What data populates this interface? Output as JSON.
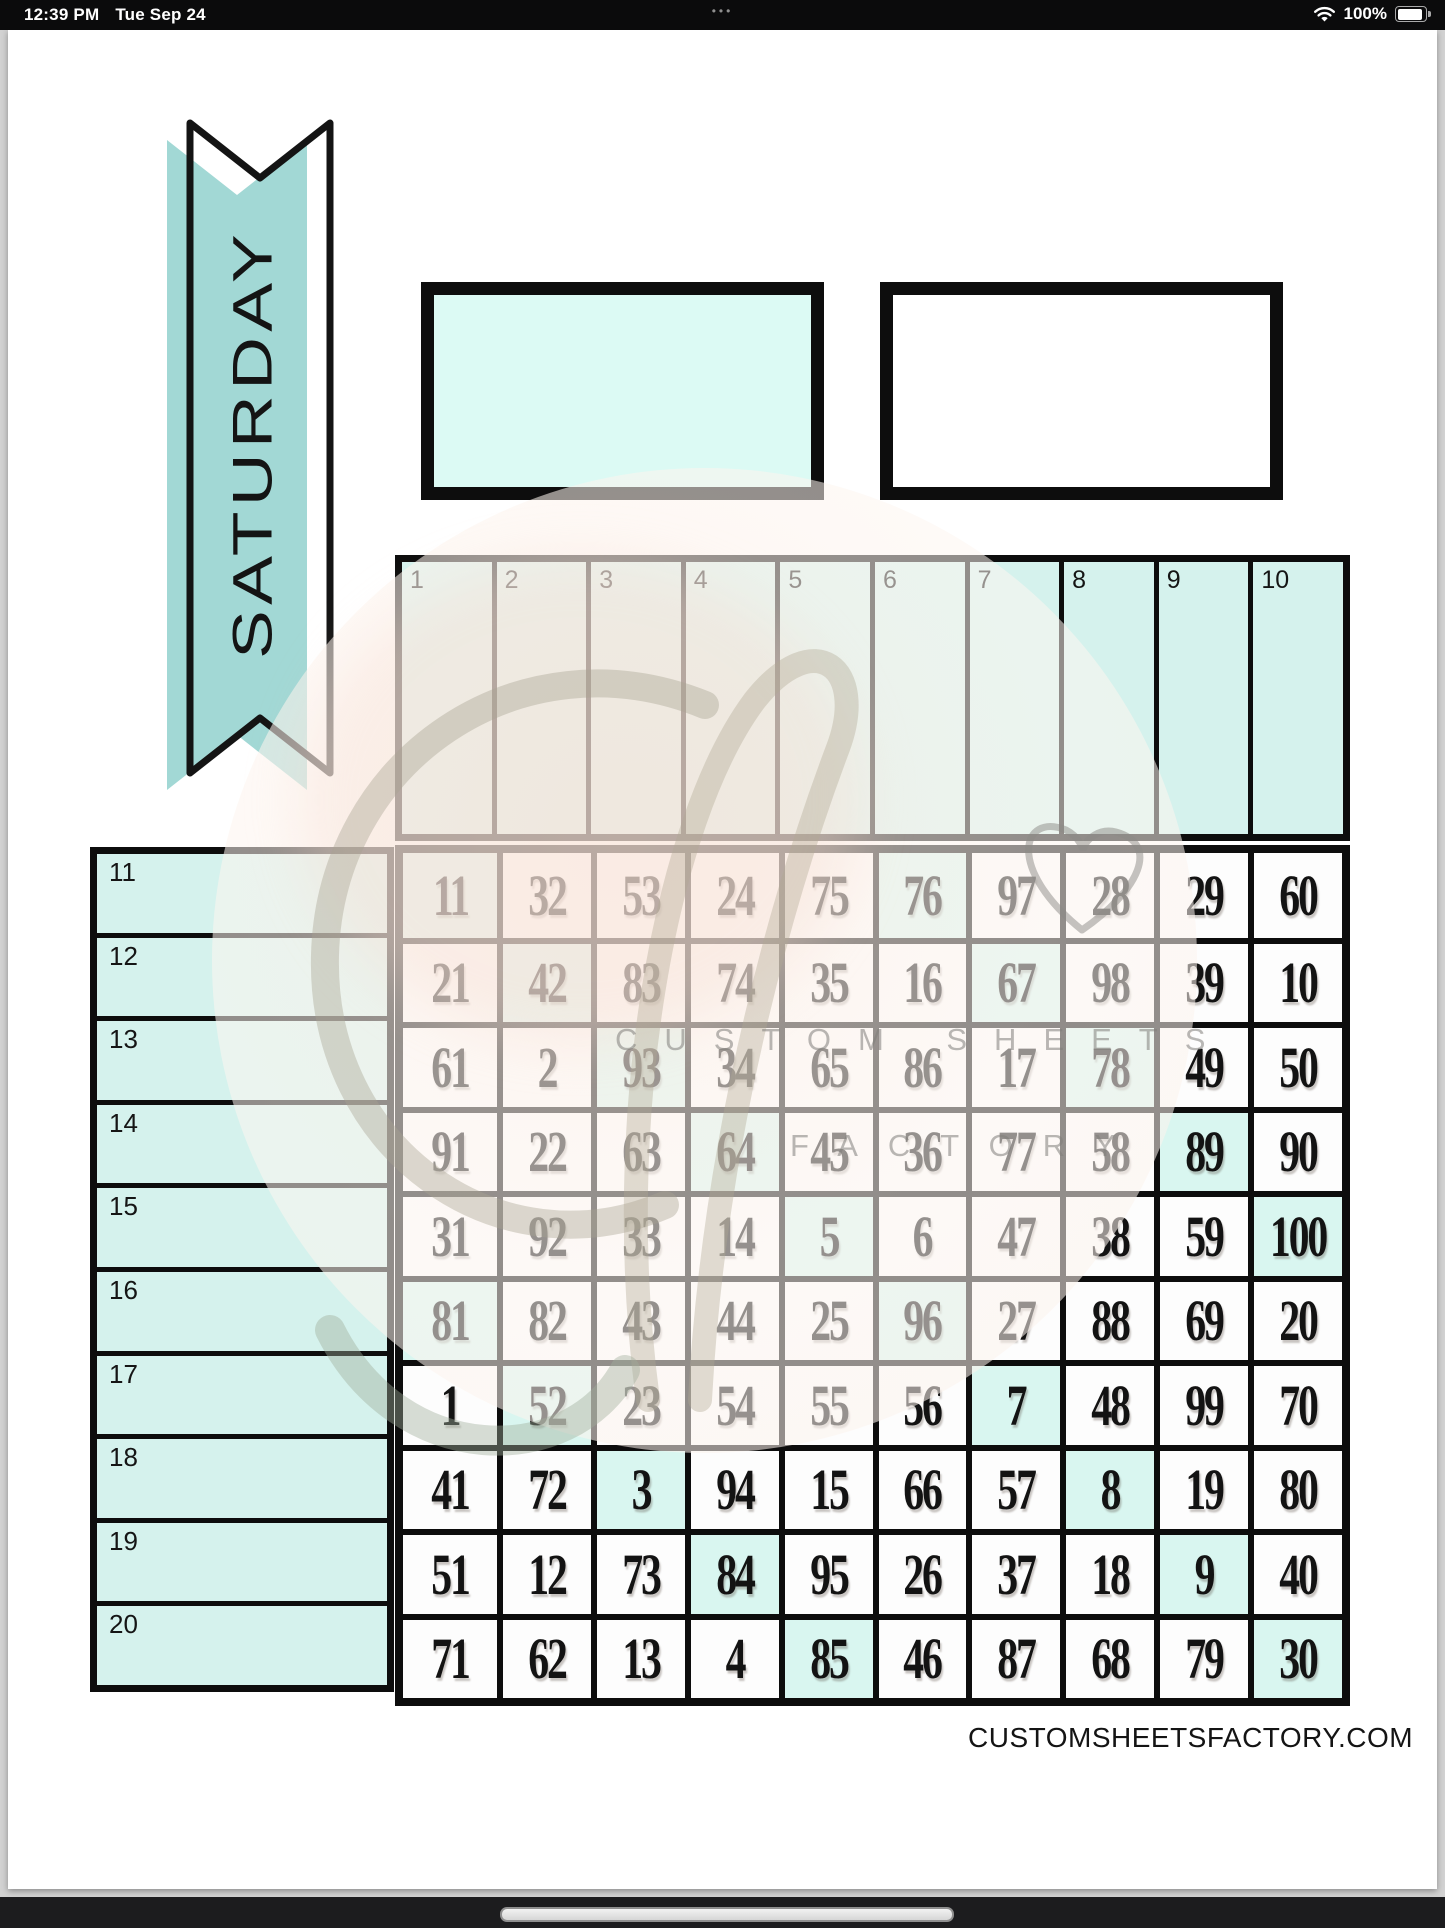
{
  "status_bar": {
    "time": "12:39 PM",
    "date": "Tue Sep 24",
    "menu_dots": "•••",
    "battery_percent": "100%"
  },
  "banner": {
    "label": "SATURDAY"
  },
  "top_columns": {
    "labels": [
      "1",
      "2",
      "3",
      "4",
      "5",
      "6",
      "7",
      "8",
      "9",
      "10"
    ]
  },
  "side_rows": {
    "labels": [
      "11",
      "12",
      "13",
      "14",
      "15",
      "16",
      "17",
      "18",
      "19",
      "20"
    ]
  },
  "number_grid": {
    "rows": [
      [
        "11",
        "32",
        "53",
        "24",
        "75",
        "76",
        "97",
        "28",
        "29",
        "60"
      ],
      [
        "21",
        "42",
        "83",
        "74",
        "35",
        "16",
        "67",
        "98",
        "39",
        "10"
      ],
      [
        "61",
        "2",
        "93",
        "34",
        "65",
        "86",
        "17",
        "78",
        "49",
        "50"
      ],
      [
        "91",
        "22",
        "63",
        "64",
        "45",
        "36",
        "77",
        "58",
        "89",
        "90"
      ],
      [
        "31",
        "92",
        "33",
        "14",
        "5",
        "6",
        "47",
        "38",
        "59",
        "100"
      ],
      [
        "81",
        "82",
        "43",
        "44",
        "25",
        "96",
        "27",
        "88",
        "69",
        "20"
      ],
      [
        "1",
        "52",
        "23",
        "54",
        "55",
        "56",
        "7",
        "48",
        "99",
        "70"
      ],
      [
        "41",
        "72",
        "3",
        "94",
        "15",
        "66",
        "57",
        "8",
        "19",
        "80"
      ],
      [
        "51",
        "12",
        "73",
        "84",
        "95",
        "26",
        "37",
        "18",
        "9",
        "40"
      ],
      [
        "71",
        "62",
        "13",
        "4",
        "85",
        "46",
        "87",
        "68",
        "79",
        "30"
      ]
    ],
    "highlighted_cells": [
      [
        0,
        0
      ],
      [
        0,
        5
      ],
      [
        1,
        1
      ],
      [
        1,
        6
      ],
      [
        2,
        2
      ],
      [
        2,
        7
      ],
      [
        3,
        3
      ],
      [
        3,
        8
      ],
      [
        4,
        4
      ],
      [
        4,
        9
      ],
      [
        5,
        0
      ],
      [
        5,
        5
      ],
      [
        6,
        1
      ],
      [
        6,
        6
      ],
      [
        7,
        2
      ],
      [
        7,
        7
      ],
      [
        8,
        3
      ],
      [
        8,
        8
      ],
      [
        9,
        4
      ],
      [
        9,
        9
      ]
    ]
  },
  "watermark": {
    "line1": "CUSTOM SHEETS",
    "line2": "FACTORY"
  },
  "footer": {
    "website": "CUSTOMSHEETSFACTORY.COM"
  },
  "colors": {
    "banner_teal": "#a2d8d5",
    "cell_mint": "#d5f2ed",
    "highlight_mint": "#d9f6f0",
    "box_mint": "#dcfaf4",
    "border_black": "#0d0d0d"
  }
}
